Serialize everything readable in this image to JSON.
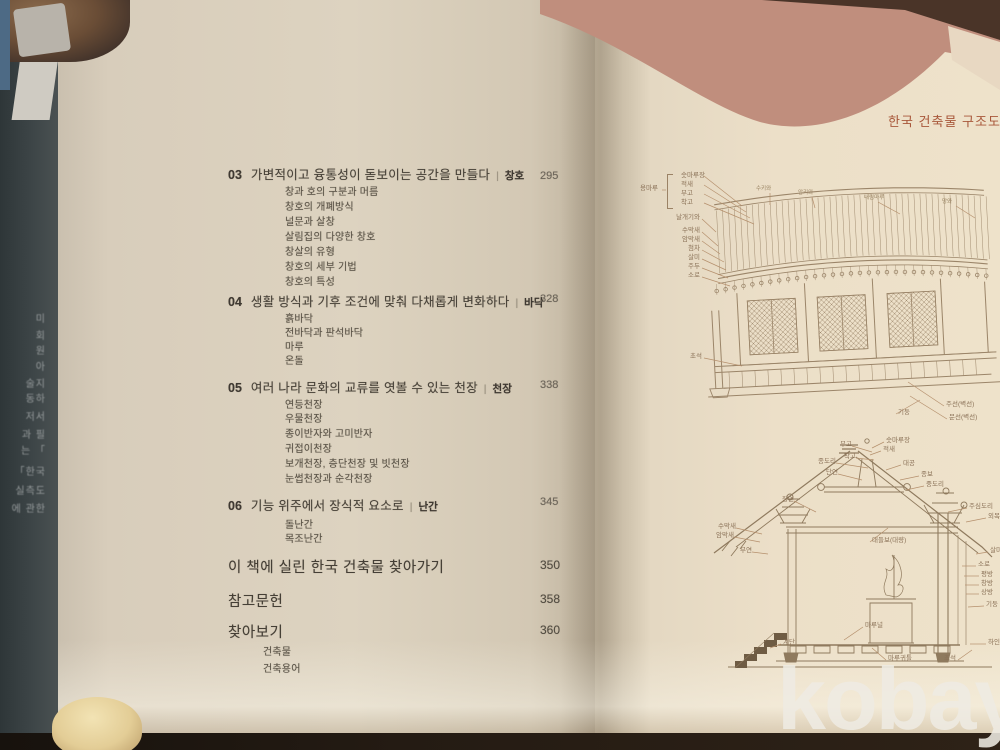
{
  "watermark": "kobay",
  "left_flap": {
    "fragments": [
      "미",
      "회",
      "원",
      "아",
      "술지",
      "동하",
      "저서",
      "과 필",
      "는 「",
      "「한국",
      "실측도",
      "에 관한"
    ]
  },
  "left_page": {
    "toc": {
      "divider": "|",
      "sections": [
        {
          "num": "03",
          "title": "가변적이고 융통성이 돋보이는 공간을 만들다",
          "category": "창호",
          "page": "295",
          "items": [
            "창과 호의 구분과 머름",
            "창호의 개폐방식",
            "널문과 살창",
            "살림집의 다양한 창호",
            "창살의 유형",
            "창호의 세부 기법",
            "창호의 특성"
          ]
        },
        {
          "num": "04",
          "title": "생활 방식과 기후 조건에 맞춰 다채롭게 변화하다",
          "category": "바닥",
          "page": "328",
          "items": [
            "흙바닥",
            "전바닥과 판석바닥",
            "마루",
            "온돌"
          ]
        },
        {
          "num": "05",
          "title": "여러 나라 문화의 교류를 엿볼 수 있는 천장",
          "category": "천장",
          "page": "338",
          "items": [
            "연등천장",
            "우물천장",
            "종이반자와 고미반자",
            "귀접이천장",
            "보개천장, 층단천장 및 빗천장",
            "눈썹천장과 순각천장"
          ]
        },
        {
          "num": "06",
          "title": "기능 위주에서 장식적 요소로",
          "category": "난간",
          "page": "345",
          "items": [
            "돌난간",
            "목조난간"
          ]
        }
      ],
      "back_matter": [
        {
          "title": "이 책에 실린 한국 건축물 찾아가기",
          "page": "350",
          "items": []
        },
        {
          "title": "참고문헌",
          "page": "358",
          "items": []
        },
        {
          "title": "찾아보기",
          "page": "360",
          "items": [
            "건축물",
            "건축용어"
          ]
        }
      ]
    }
  },
  "right_page": {
    "header": "한국 건축물 구조도",
    "elevation": {
      "ridge_group_label": "용마루",
      "ridge_parts": [
        "숫마루장",
        "적새",
        "부고",
        "착고"
      ],
      "left_labels": [
        "날개기와",
        "수막새",
        "암막새",
        "첨차",
        "살미",
        "주두",
        "소로"
      ],
      "base_label": "초석",
      "top_labels": [
        "수키와",
        "암키와",
        "내림마루",
        "망와"
      ],
      "right_labels": [
        "기둥",
        "주선(벽선)",
        "문선(벽선)"
      ]
    },
    "section": {
      "left_labels": [
        "부고",
        "착고",
        "종도리",
        "단연",
        "장연",
        "수막새",
        "암막새",
        "부연"
      ],
      "right_labels": [
        "숫마루장",
        "적새",
        "대공",
        "종보",
        "중도리",
        "주심도리",
        "외목도리",
        "대들보(대량)"
      ],
      "column_labels": [
        "살미",
        "소로",
        "평방",
        "창방",
        "상방",
        "기둥",
        "하인방"
      ],
      "bottom_labels": [
        "계단",
        "마루널",
        "마루귀틀",
        "초석"
      ]
    }
  }
}
